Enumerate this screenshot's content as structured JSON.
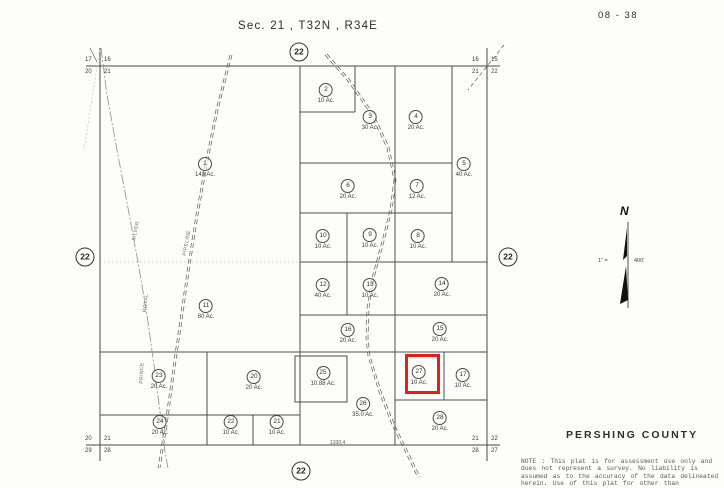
{
  "page": {
    "sheet_number": "08 - 38",
    "title": "Sec. 21 , T32N , R34E",
    "county": "PERSHING  COUNTY",
    "north_label": "N",
    "scale_left": "1\" =",
    "scale_right": "400'",
    "note_lines": [
      "NOTE : This plat is for assessment use only and",
      "does not represent a survey. No liability is",
      "assumed as to the accuracy of the data delineated",
      "herein. Use of this plat for other than"
    ]
  },
  "colors": {
    "highlight": "#e41f1a",
    "map_line": "#474747"
  },
  "adjacent_sections": [
    {
      "label": "22",
      "x": 299,
      "y": 52
    },
    {
      "label": "22",
      "x": 85,
      "y": 257
    },
    {
      "label": "22",
      "x": 508,
      "y": 257
    },
    {
      "label": "22",
      "x": 301,
      "y": 471
    }
  ],
  "corner_labels": [
    {
      "id": "top-left",
      "above_left": "17",
      "above_right": "16",
      "below_left": "20",
      "below_right": "21",
      "x": 100,
      "y": 66
    },
    {
      "id": "top-right",
      "above_left": "16",
      "above_right": "15",
      "below_left": "21",
      "below_right": "22",
      "x": 487,
      "y": 66
    },
    {
      "id": "bottom-left",
      "above_left": "20",
      "above_right": "21",
      "below_left": "29",
      "below_right": "28",
      "x": 100,
      "y": 445
    },
    {
      "id": "bottom-right",
      "above_left": "21",
      "above_right": "22",
      "below_left": "28",
      "below_right": "27",
      "x": 487,
      "y": 445
    }
  ],
  "parcels": [
    {
      "num": "1",
      "acreage": "140 Ac.",
      "x": 205,
      "y": 157
    },
    {
      "num": "2",
      "acreage": "10 Ac.",
      "x": 326,
      "y": 83
    },
    {
      "num": "3",
      "acreage": "30 Ac.",
      "x": 370,
      "y": 110
    },
    {
      "num": "4",
      "acreage": "20 Ac.",
      "x": 416,
      "y": 110
    },
    {
      "num": "5",
      "acreage": "40 Ac.",
      "x": 464,
      "y": 157
    },
    {
      "num": "6",
      "acreage": "20 Ac.",
      "x": 348,
      "y": 179
    },
    {
      "num": "7",
      "acreage": "12 Ac.",
      "x": 417,
      "y": 179
    },
    {
      "num": "8",
      "acreage": "10 Ac.",
      "x": 418,
      "y": 229
    },
    {
      "num": "9",
      "acreage": "10 Ac.",
      "x": 370,
      "y": 228
    },
    {
      "num": "10",
      "acreage": "10 Ac.",
      "x": 323,
      "y": 229
    },
    {
      "num": "11",
      "acreage": "80 Ac.",
      "x": 206,
      "y": 299
    },
    {
      "num": "12",
      "acreage": "40 Ac.",
      "x": 323,
      "y": 278
    },
    {
      "num": "13",
      "acreage": "10 Ac.",
      "x": 370,
      "y": 278
    },
    {
      "num": "14",
      "acreage": "20 Ac.",
      "x": 442,
      "y": 277
    },
    {
      "num": "15",
      "acreage": "20 Ac.",
      "x": 440,
      "y": 322
    },
    {
      "num": "16",
      "acreage": "20 Ac.",
      "x": 348,
      "y": 323
    },
    {
      "num": "17",
      "acreage": "10 Ac.",
      "x": 463,
      "y": 368
    },
    {
      "num": "20",
      "acreage": "20 Ac.",
      "x": 254,
      "y": 370
    },
    {
      "num": "21",
      "acreage": "10 Ac.",
      "x": 277,
      "y": 415
    },
    {
      "num": "22",
      "acreage": "10 Ac.",
      "x": 231,
      "y": 415
    },
    {
      "num": "23",
      "acreage": "20 Ac.",
      "x": 159,
      "y": 369
    },
    {
      "num": "24",
      "acreage": "20 Ac.",
      "x": 160,
      "y": 415
    },
    {
      "num": "25",
      "acreage": "10.88 Ac.",
      "x": 323,
      "y": 366
    },
    {
      "num": "26",
      "acreage": "35.0 Ac.",
      "x": 363,
      "y": 397
    },
    {
      "num": "27",
      "acreage": "10 Ac.",
      "x": 419,
      "y": 365,
      "highlighted": true
    },
    {
      "num": "28",
      "acreage": "20 Ac.",
      "x": 440,
      "y": 411
    }
  ],
  "highlight_box": {
    "x": 405,
    "y": 354,
    "w": 29,
    "h": 34
  },
  "road_labels": [
    {
      "text": "SILVER",
      "x": 136,
      "y": 231,
      "rotate": -78
    },
    {
      "text": "PIPELINE",
      "x": 187,
      "y": 243,
      "rotate": -80
    },
    {
      "text": "ROYAL",
      "x": 146,
      "y": 303,
      "rotate": -84
    },
    {
      "text": "PRINCE",
      "x": 142,
      "y": 373,
      "rotate": -88
    }
  ],
  "dimensions": [
    {
      "text": "1330.4",
      "x": 330,
      "y": 440
    }
  ]
}
